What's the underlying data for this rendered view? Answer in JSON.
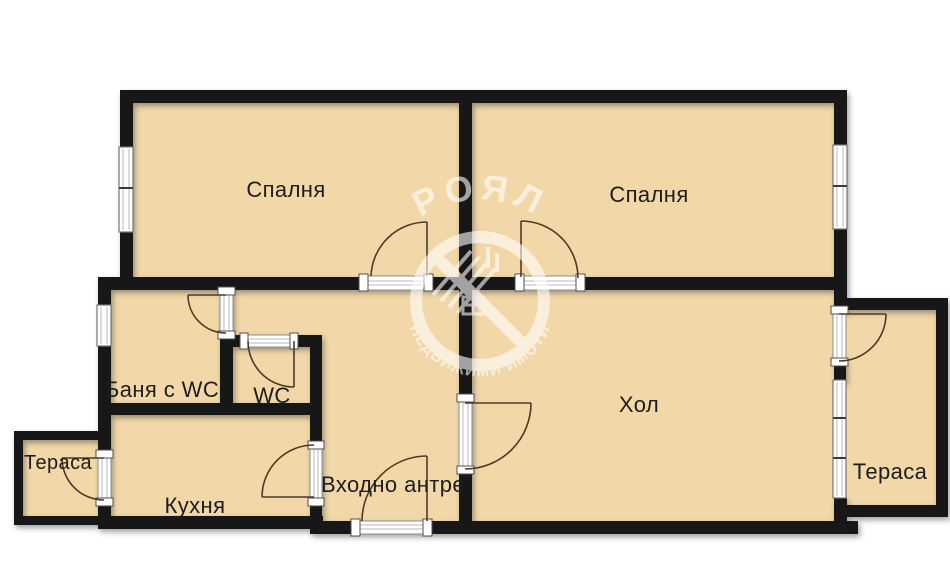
{
  "watermark": {
    "brand": "РОЯЛ",
    "tagline": "НЕДВИЖИМИ ИМОТИ",
    "color": "#ffffff"
  },
  "colors": {
    "floor": "#f2d8a8",
    "wall": "#171717",
    "label": "#1d1d1d",
    "door_swing": "#4c3a26",
    "background": "#ffffff"
  },
  "rooms": [
    {
      "name": "bedroom-left",
      "label": "Спалня"
    },
    {
      "name": "bedroom-right",
      "label": "Спалня"
    },
    {
      "name": "bathroom-wc",
      "label": "Баня с WC"
    },
    {
      "name": "wc",
      "label": "WC"
    },
    {
      "name": "terrace-left",
      "label": "Тераса"
    },
    {
      "name": "kitchen",
      "label": "Кухня"
    },
    {
      "name": "entry-hall",
      "label": "Входно антре"
    },
    {
      "name": "living-room",
      "label": "Хол"
    },
    {
      "name": "terrace-right",
      "label": "Тераса"
    }
  ]
}
